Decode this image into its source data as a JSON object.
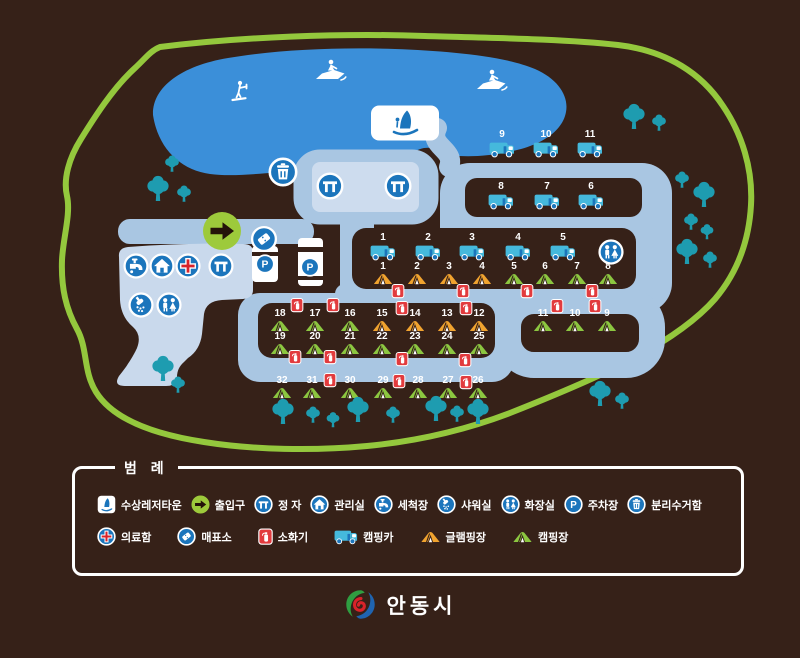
{
  "legend": {
    "title": "범 례",
    "rows": [
      [
        {
          "icon": "sail",
          "label": "수상레저타운"
        },
        {
          "icon": "entrance",
          "label": "출입구"
        },
        {
          "icon": "pavilion",
          "label": "정 자"
        },
        {
          "icon": "house",
          "label": "관리실"
        },
        {
          "icon": "faucet",
          "label": "세척장"
        },
        {
          "icon": "shower",
          "label": "샤워실"
        },
        {
          "icon": "toilet",
          "label": "화장실"
        },
        {
          "icon": "parking",
          "label": "주차장"
        },
        {
          "icon": "trash",
          "label": "분리수거함"
        }
      ],
      [
        {
          "icon": "medical",
          "label": "의료함"
        },
        {
          "icon": "ticket",
          "label": "매표소"
        },
        {
          "icon": "ext",
          "label": "소화기"
        },
        {
          "icon": "truck",
          "label": "캠핑카"
        },
        {
          "icon": "tent-orange",
          "label": "글램핑장"
        },
        {
          "icon": "tent-green",
          "label": "캠핑장"
        }
      ]
    ]
  },
  "footer": {
    "city": "안동시"
  },
  "map": {
    "colors": {
      "background": "#362118",
      "boundary_road": "#94c83d",
      "lake": "#3b8fd9",
      "inner_road": "#a9c6e2",
      "facility_area": "#c9d9ec",
      "icon_blue": "#1b75bc",
      "tree": "#1e9cb0",
      "camping_tent_green": "#8cc640",
      "glamping_tent_orange": "#f0a32f",
      "fire_red": "#e23b3e",
      "camping_car_cyan": "#45b9dc"
    },
    "markers": [
      {
        "t": "ski",
        "x": 240,
        "y": 92
      },
      {
        "t": "jet",
        "x": 331,
        "y": 70
      },
      {
        "t": "jet",
        "x": 492,
        "y": 80
      },
      {
        "t": "sail",
        "x": 405,
        "y": 123
      },
      {
        "t": "fac",
        "g": "trash",
        "x": 283,
        "y": 172,
        "d": 30
      },
      {
        "t": "fac",
        "g": "pavilion",
        "x": 330,
        "y": 186,
        "d": 28
      },
      {
        "t": "fac",
        "g": "pavilion",
        "x": 398,
        "y": 186,
        "d": 28
      },
      {
        "t": "entrance",
        "x": 222,
        "y": 231
      },
      {
        "t": "fac",
        "g": "ticket",
        "x": 264,
        "y": 239,
        "d": 27
      },
      {
        "t": "fac",
        "g": "parking",
        "x": 265,
        "y": 264,
        "d": 20
      },
      {
        "t": "fac",
        "g": "parking",
        "x": 310,
        "y": 267,
        "d": 20
      },
      {
        "t": "fac",
        "g": "faucet",
        "x": 136,
        "y": 266,
        "d": 26
      },
      {
        "t": "fac",
        "g": "house",
        "x": 162,
        "y": 266,
        "d": 26
      },
      {
        "t": "fac",
        "g": "medical",
        "x": 188,
        "y": 266,
        "d": 26
      },
      {
        "t": "fac",
        "g": "pavilion",
        "x": 221,
        "y": 266,
        "d": 26
      },
      {
        "t": "fac",
        "g": "shower",
        "x": 141,
        "y": 305,
        "d": 26
      },
      {
        "t": "fac",
        "g": "toilet",
        "x": 169,
        "y": 305,
        "d": 26
      },
      {
        "t": "fac",
        "g": "toilet",
        "x": 611,
        "y": 252,
        "d": 26
      },
      {
        "t": "truck",
        "n": "9",
        "x": 502,
        "y": 149
      },
      {
        "t": "truck",
        "n": "10",
        "x": 546,
        "y": 149
      },
      {
        "t": "truck",
        "n": "11",
        "x": 590,
        "y": 149
      },
      {
        "t": "truck",
        "n": "8",
        "x": 501,
        "y": 201
      },
      {
        "t": "truck",
        "n": "7",
        "x": 547,
        "y": 201
      },
      {
        "t": "truck",
        "n": "6",
        "x": 591,
        "y": 201
      },
      {
        "t": "truck",
        "n": "1",
        "x": 383,
        "y": 252
      },
      {
        "t": "truck",
        "n": "2",
        "x": 428,
        "y": 252
      },
      {
        "t": "truck",
        "n": "3",
        "x": 472,
        "y": 252
      },
      {
        "t": "truck",
        "n": "4",
        "x": 518,
        "y": 252
      },
      {
        "t": "truck",
        "n": "5",
        "x": 563,
        "y": 252
      },
      {
        "t": "tent_o",
        "n": "1",
        "x": 383,
        "y": 279
      },
      {
        "t": "tent_o",
        "n": "2",
        "x": 417,
        "y": 279
      },
      {
        "t": "tent_o",
        "n": "3",
        "x": 449,
        "y": 279
      },
      {
        "t": "tent_o",
        "n": "4",
        "x": 482,
        "y": 279
      },
      {
        "t": "tent_g",
        "n": "5",
        "x": 514,
        "y": 279
      },
      {
        "t": "tent_g",
        "n": "6",
        "x": 545,
        "y": 279
      },
      {
        "t": "tent_g",
        "n": "7",
        "x": 577,
        "y": 279
      },
      {
        "t": "tent_g",
        "n": "8",
        "x": 608,
        "y": 279
      },
      {
        "t": "tent_g",
        "n": "18",
        "x": 280,
        "y": 326
      },
      {
        "t": "tent_g",
        "n": "17",
        "x": 315,
        "y": 326
      },
      {
        "t": "tent_g",
        "n": "16",
        "x": 350,
        "y": 326
      },
      {
        "t": "tent_o",
        "n": "15",
        "x": 382,
        "y": 326
      },
      {
        "t": "tent_o",
        "n": "14",
        "x": 415,
        "y": 326
      },
      {
        "t": "tent_o",
        "n": "13",
        "x": 447,
        "y": 326
      },
      {
        "t": "tent_o",
        "n": "12",
        "x": 479,
        "y": 326
      },
      {
        "t": "tent_g",
        "n": "11",
        "x": 543,
        "y": 326
      },
      {
        "t": "tent_g",
        "n": "10",
        "x": 575,
        "y": 326
      },
      {
        "t": "tent_g",
        "n": "9",
        "x": 607,
        "y": 326
      },
      {
        "t": "tent_g",
        "n": "19",
        "x": 280,
        "y": 349
      },
      {
        "t": "tent_g",
        "n": "20",
        "x": 315,
        "y": 349
      },
      {
        "t": "tent_g",
        "n": "21",
        "x": 350,
        "y": 349
      },
      {
        "t": "tent_g",
        "n": "22",
        "x": 382,
        "y": 349
      },
      {
        "t": "tent_g",
        "n": "23",
        "x": 415,
        "y": 349
      },
      {
        "t": "tent_g",
        "n": "24",
        "x": 447,
        "y": 349
      },
      {
        "t": "tent_g",
        "n": "25",
        "x": 479,
        "y": 349
      },
      {
        "t": "tent_g",
        "n": "32",
        "x": 282,
        "y": 393
      },
      {
        "t": "tent_g",
        "n": "31",
        "x": 312,
        "y": 393
      },
      {
        "t": "tent_g",
        "n": "30",
        "x": 350,
        "y": 393
      },
      {
        "t": "tent_g",
        "n": "29",
        "x": 383,
        "y": 393
      },
      {
        "t": "tent_g",
        "n": "28",
        "x": 418,
        "y": 393
      },
      {
        "t": "tent_g",
        "n": "27",
        "x": 448,
        "y": 393
      },
      {
        "t": "tent_g",
        "n": "26",
        "x": 478,
        "y": 393
      },
      {
        "t": "ext",
        "x": 398,
        "y": 291
      },
      {
        "t": "ext",
        "x": 463,
        "y": 291
      },
      {
        "t": "ext",
        "x": 527,
        "y": 291
      },
      {
        "t": "ext",
        "x": 592,
        "y": 291
      },
      {
        "t": "ext",
        "x": 297,
        "y": 305
      },
      {
        "t": "ext",
        "x": 333,
        "y": 305
      },
      {
        "t": "ext",
        "x": 402,
        "y": 308
      },
      {
        "t": "ext",
        "x": 466,
        "y": 308
      },
      {
        "t": "ext",
        "x": 557,
        "y": 306
      },
      {
        "t": "ext",
        "x": 595,
        "y": 306
      },
      {
        "t": "ext",
        "x": 295,
        "y": 357
      },
      {
        "t": "ext",
        "x": 330,
        "y": 357
      },
      {
        "t": "ext",
        "x": 402,
        "y": 359
      },
      {
        "t": "ext",
        "x": 465,
        "y": 360
      },
      {
        "t": "ext",
        "x": 330,
        "y": 380
      },
      {
        "t": "ext",
        "x": 399,
        "y": 381
      },
      {
        "t": "ext",
        "x": 466,
        "y": 382
      },
      {
        "t": "tree",
        "x": 172,
        "y": 164,
        "s": 0.65
      },
      {
        "t": "tree",
        "x": 158,
        "y": 189,
        "s": 1
      },
      {
        "t": "tree",
        "x": 184,
        "y": 194,
        "s": 0.65
      },
      {
        "t": "tree",
        "x": 634,
        "y": 117,
        "s": 1
      },
      {
        "t": "tree",
        "x": 659,
        "y": 123,
        "s": 0.65
      },
      {
        "t": "tree",
        "x": 682,
        "y": 180,
        "s": 0.65
      },
      {
        "t": "tree",
        "x": 704,
        "y": 195,
        "s": 1
      },
      {
        "t": "tree",
        "x": 691,
        "y": 222,
        "s": 0.65
      },
      {
        "t": "tree",
        "x": 707,
        "y": 232,
        "s": 0.6
      },
      {
        "t": "tree",
        "x": 687,
        "y": 252,
        "s": 1
      },
      {
        "t": "tree",
        "x": 710,
        "y": 260,
        "s": 0.65
      },
      {
        "t": "tree",
        "x": 600,
        "y": 394,
        "s": 1
      },
      {
        "t": "tree",
        "x": 622,
        "y": 401,
        "s": 0.65
      },
      {
        "t": "tree",
        "x": 283,
        "y": 412,
        "s": 1
      },
      {
        "t": "tree",
        "x": 313,
        "y": 415,
        "s": 0.65
      },
      {
        "t": "tree",
        "x": 333,
        "y": 420,
        "s": 0.6
      },
      {
        "t": "tree",
        "x": 358,
        "y": 410,
        "s": 1
      },
      {
        "t": "tree",
        "x": 393,
        "y": 415,
        "s": 0.65
      },
      {
        "t": "tree",
        "x": 436,
        "y": 409,
        "s": 1
      },
      {
        "t": "tree",
        "x": 457,
        "y": 414,
        "s": 0.65
      },
      {
        "t": "tree",
        "x": 478,
        "y": 412,
        "s": 1
      },
      {
        "t": "tree",
        "x": 163,
        "y": 369,
        "s": 1
      },
      {
        "t": "tree",
        "x": 178,
        "y": 385,
        "s": 0.65
      }
    ]
  }
}
